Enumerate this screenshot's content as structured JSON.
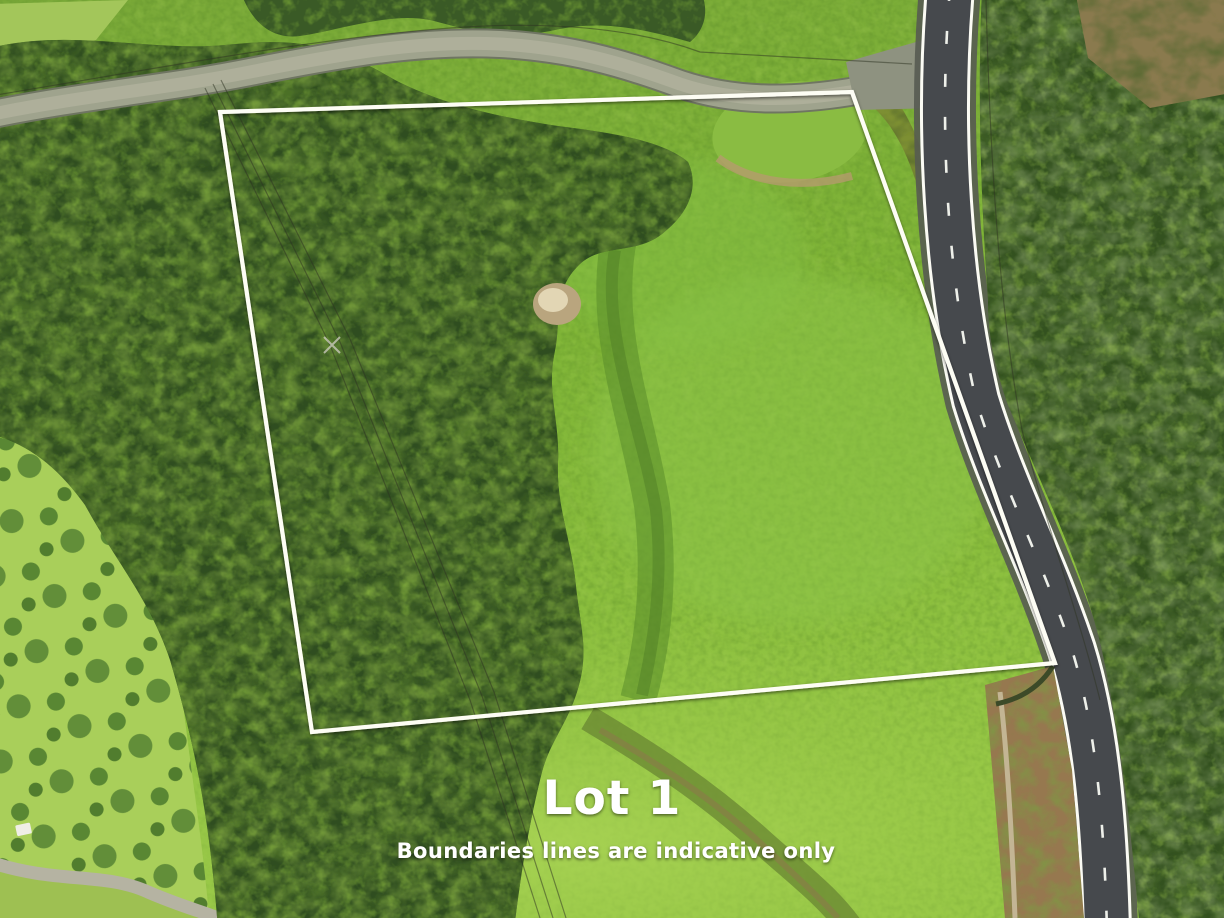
{
  "photo": {
    "description": "aerial drone photograph of a rural land parcel for sale",
    "lot": {
      "label": "Lot 1"
    },
    "disclaimer": {
      "text": "Boundaries lines are indicative only"
    },
    "boundary": {
      "points": "220,112 852,92 1055,663 312,732",
      "color": "#fdfdf4"
    },
    "colors": {
      "pasture_bright": "#8fc23f",
      "pasture_light": "#a9cf5a",
      "forest_dark": "#2f4d20",
      "forest_mid": "#4c7028",
      "forest_light": "#7fa83b",
      "road_asphalt": "#46494d",
      "road_marking": "#f2f3ee",
      "gravel_road": "#9fa38d",
      "dirt_driveway": "#96784f",
      "bare_patch": "#cdbb95",
      "label_text": "#ffffff"
    }
  }
}
